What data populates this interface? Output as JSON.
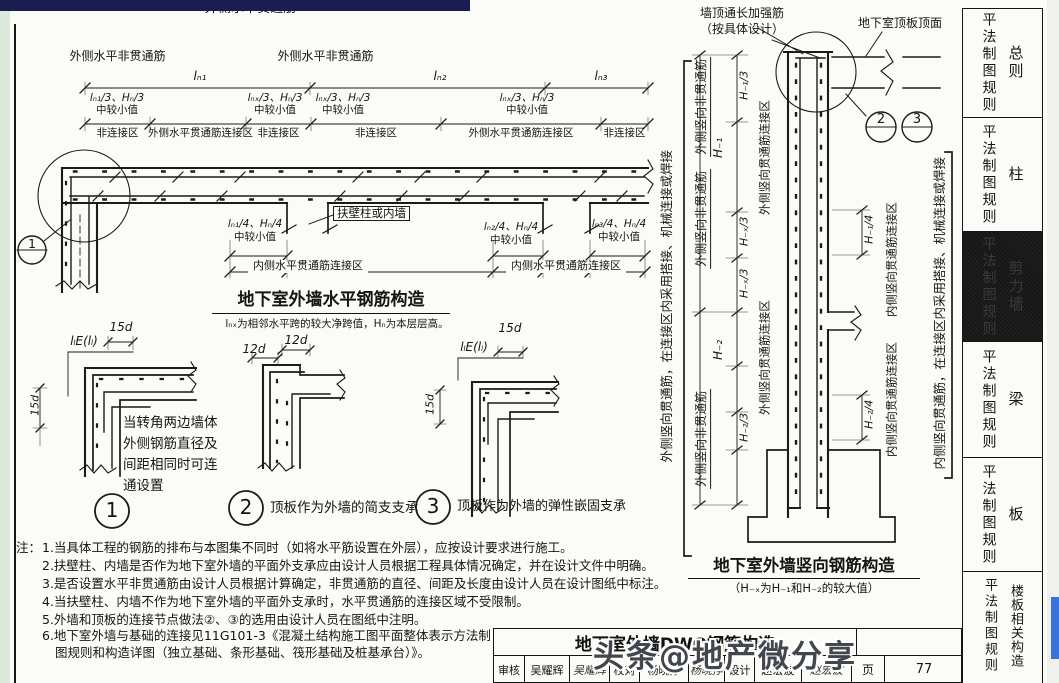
{
  "chrome": {
    "watermark": "头条@地产微分享"
  },
  "sidebar": {
    "tabs": [
      {
        "rule": "平法制图规则",
        "cat": "总则"
      },
      {
        "rule": "平法制图规则",
        "cat": "柱"
      },
      {
        "rule": "平法制图规则",
        "cat": "剪力墙"
      },
      {
        "rule": "平法制图规则",
        "cat": "梁"
      },
      {
        "rule": "平法制图规则",
        "cat": "板"
      },
      {
        "rule": "平法制图规则",
        "cat": "楼板相关构造"
      }
    ]
  },
  "h": {
    "top_bracket": "外侧水平贯通筋",
    "nt1": "外侧水平非贯通筋",
    "nt2": "外侧水平非贯通筋",
    "span1": "lₙ₁",
    "span2": "lₙ₂",
    "span3": "lₙ₃",
    "min1a": "lₙ₁/3、Hₙ/3",
    "min1b": "中较小值",
    "min2a": "lₙₓ/3、Hₙ/3",
    "min2b": "中较小值",
    "min3a": "lₙₓ/3、Hₙ/3",
    "min3b": "中较小值",
    "min4a": "lₙₓ/3、Hₙ/3",
    "min4b": "中较小值",
    "zones": [
      "非连接区",
      "外侧水平贯通筋连接区",
      "非连接区",
      "非连接区",
      "外侧水平贯通筋连接区",
      "非连接区"
    ],
    "pier": "扶壁柱或内墙",
    "q1a": "lₙ₁/4、Hₙ/4",
    "q1b": "中较小值",
    "q2a": "lₙ₂/4、Hₙ/4",
    "q2b": "中较小值",
    "q3a": "lₙ₃/4、Hₙ/4",
    "q3b": "中较小值",
    "inner_zone1": "内侧水平贯通筋连接区",
    "inner_zone2": "内侧水平贯通筋连接区",
    "title": "地下室外墙水平钢筋构造",
    "subtitle": "lₙₓ为相邻水平跨的较大净跨值，Hₙ为本层层高。",
    "bubble1": "1"
  },
  "v": {
    "top_note1": "墙顶通长加强筋",
    "top_note2": "（按具体设计）",
    "slab_top": "地下室顶板顶面",
    "bubble2": "2",
    "bubble3": "3",
    "left_bracket": "外侧竖向贯通筋，在连接区内采用搭接、机械连接或焊接",
    "right_bracket": "内侧竖向贯通筋，在连接区内采用搭接、机械连接或焊接",
    "nt": [
      "外侧竖向非贯通筋",
      "外侧竖向非贯通筋",
      "外侧竖向非贯通筋"
    ],
    "cz_out1": "外侧竖向贯通筋连接区",
    "cz_out2": "外侧竖向贯通筋连接区",
    "cz_in1": "内侧竖向贯通筋连接区",
    "cz_in2": "内侧竖向贯通筋连接区",
    "h1_3": "H₋₁/3",
    "hx3a": "H₋ₓ/3",
    "hx3b": "H₋ₓ/3",
    "h2_3": "H₋₂/3",
    "h1": "H₋₁",
    "h2": "H₋₂",
    "h1_4": "H₋₁/4",
    "h2_4": "H₋₂/4",
    "title": "地下室外墙竖向钢筋构造",
    "subtitle": "（H₋ₓ为H₋₁和H₋₂的较大值）"
  },
  "details": {
    "d1": {
      "dim_top": "15d",
      "dim_lap": "lₗE(lₗ)",
      "dim_side": "15d",
      "note": "当转角两边墙体外侧钢筋直径及间距相同时可连通设置",
      "num": "1"
    },
    "d2": {
      "dim_a": "12d",
      "dim_b": "12d",
      "num": "2",
      "caption": "顶板作为外墙的简支支承"
    },
    "d3": {
      "dim_top": "15d",
      "dim_lap": "lₗE(lₗ)",
      "dim_side": "15d",
      "num": "3",
      "caption": "顶板作为外墙的弹性嵌固支承"
    }
  },
  "notes": {
    "head": "注：",
    "items": [
      "1.当具体工程的钢筋的排布与本图集不同时（如将水平筋设置在外层），应按设计要求进行施工。",
      "2.扶壁柱、内墙是否作为地下室外墙的平面外支承应由设计人员根据工程具体情况确定，并在设计文件中明确。",
      "3.是否设置水平非贯通筋由设计人员根据计算确定，非贯通筋的直径、间距及长度由设计人员在设计图纸中标注。",
      "4.当扶壁柱、内墙不作为地下室外墙的平面外支承时，水平贯通筋的连接区域不受限制。",
      "5.外墙和顶板的连接节点做法②、③的选用由设计人员在图纸中注明。",
      "6.地下室外墙与基础的连接见11G101-3《混凝土结构施工图平面整体表示方法制图规则和构造详图（独立基础、条形基础、筏形基础及桩基承台）》。"
    ]
  },
  "titleblock": {
    "title": "地下室外墙DWQ钢筋构造",
    "cells": [
      {
        "label": "审核",
        "name": "吴耀辉",
        "sig": "吴耀辉"
      },
      {
        "label": "校对",
        "name": "杨晓挣",
        "sig": "杨晓挣"
      },
      {
        "label": "设计",
        "name": "赵宏波",
        "sig": "赵宏波"
      }
    ],
    "page_label": "页",
    "page_number": "77"
  }
}
